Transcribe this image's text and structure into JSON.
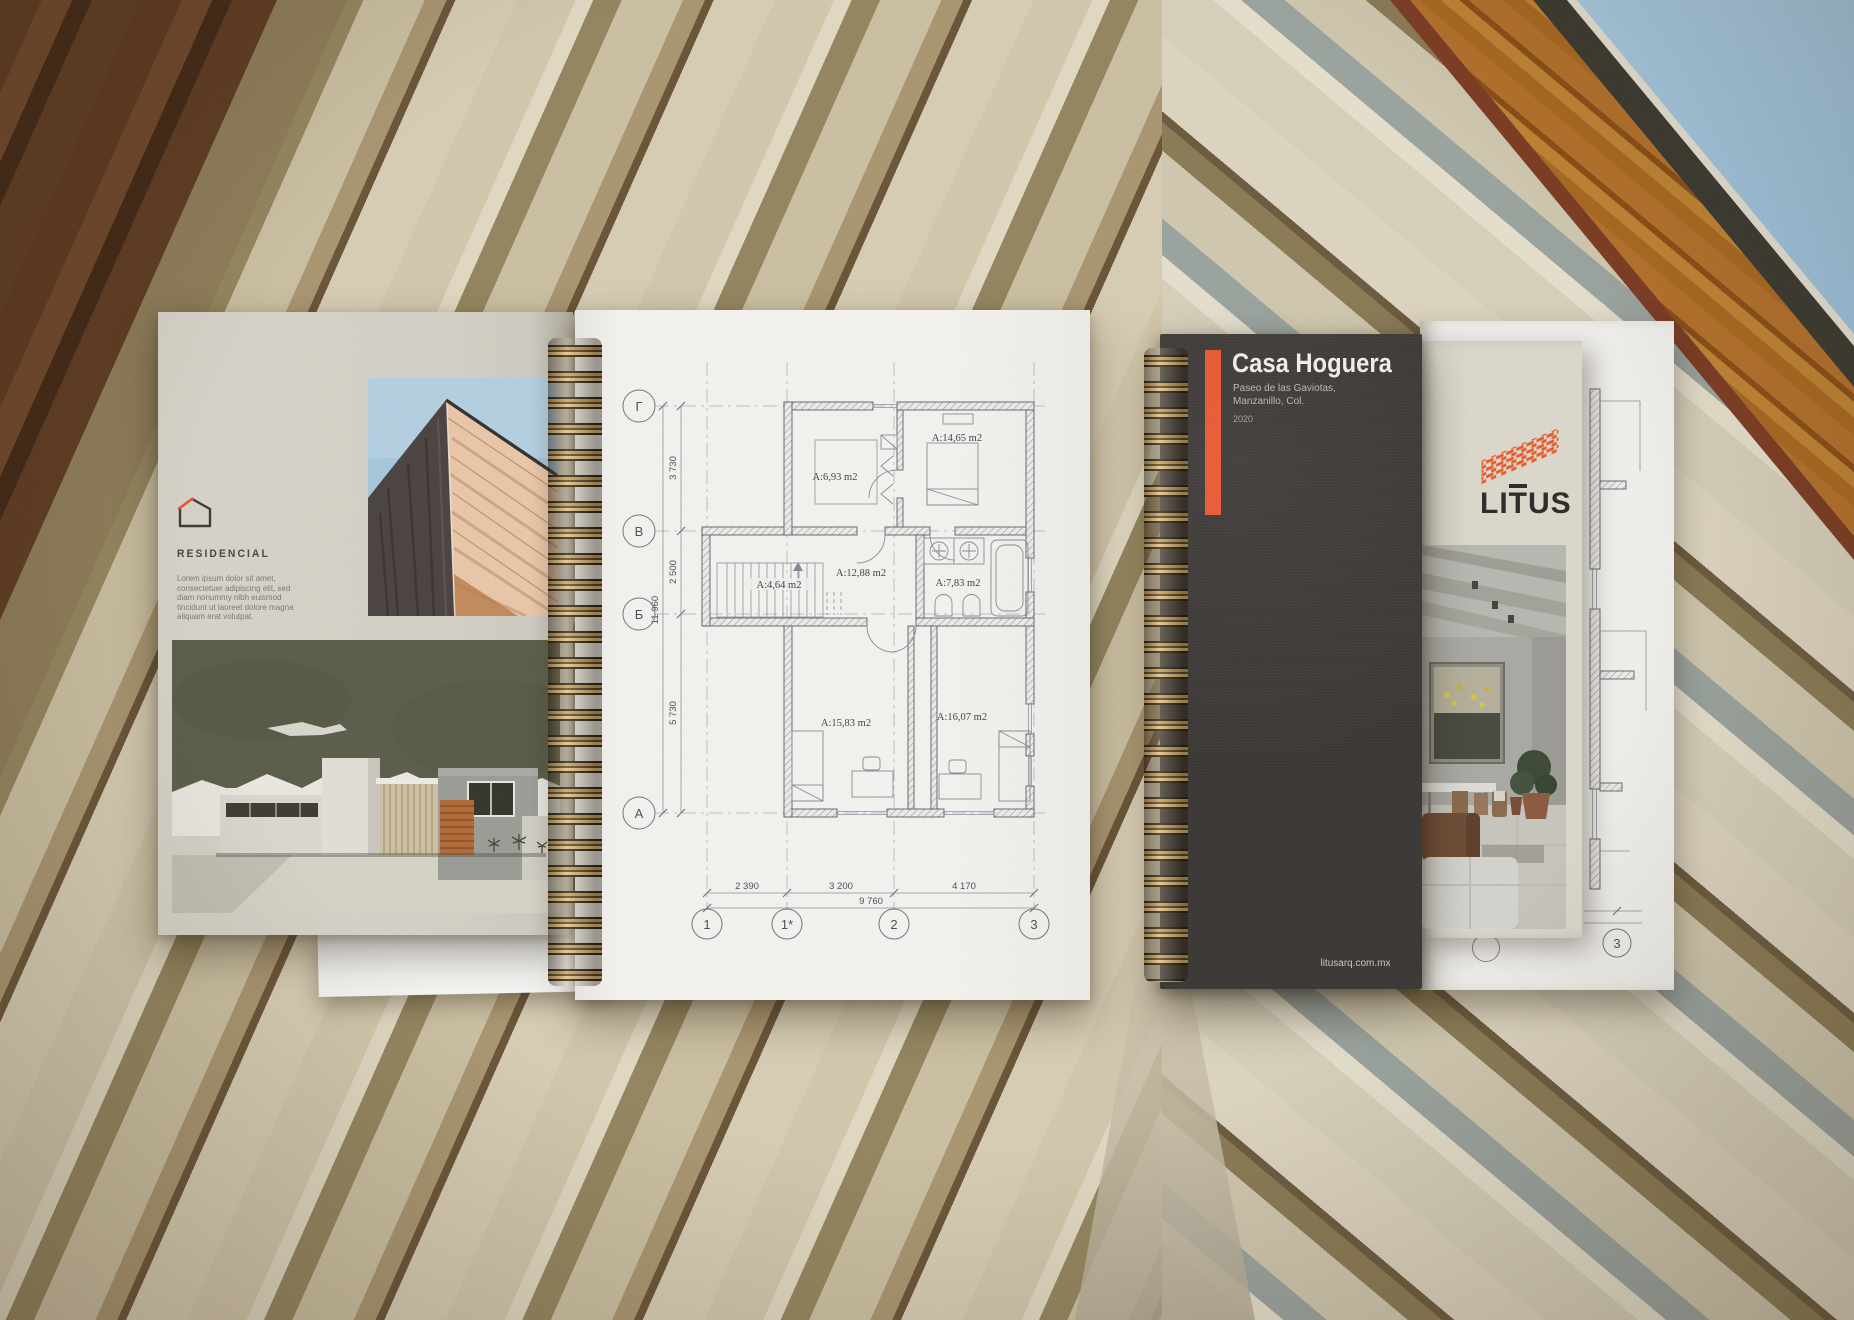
{
  "left_brochure": {
    "section_label": "RESIDENCIAL",
    "body_text": "Lorem ipsum dolor sit amet, consectetuer adipiscing elit, sed diam nonummy nibh euismod tincidunt ut laoreet dolore magna aliquam erat volutpat.",
    "accent_color": "#e05a2b"
  },
  "floor_plan": {
    "row_axes": [
      "Г",
      "В",
      "Б",
      "А"
    ],
    "col_axes": [
      "1",
      "1*",
      "2",
      "3"
    ],
    "vertical_dims": {
      "segments": [
        "3 730",
        "2 500",
        "5 730"
      ],
      "total": "11 960"
    },
    "horizontal_dims": {
      "segments": [
        "2 390",
        "3 200",
        "4 170"
      ],
      "total": "9 760"
    },
    "rooms": [
      {
        "label": "A:6,93 m2"
      },
      {
        "label": "A:14,65 m2"
      },
      {
        "label": "A:12,88 m2"
      },
      {
        "label": "A:4,64 m2"
      },
      {
        "label": "A:7,83 m2"
      },
      {
        "label": "A:15,83 m2"
      },
      {
        "label": "A:16,07 m2"
      }
    ]
  },
  "right_brochure": {
    "title": "Casa Hoguera",
    "address_line1": "Paseo de las Gaviotas,",
    "address_line2": "Manzanillo, Col.",
    "year": "2020",
    "brand": "LITUS",
    "website": "litusarq.com.mx",
    "accent_color": "#e8552e"
  },
  "back_page": {
    "axis_label": "3"
  }
}
